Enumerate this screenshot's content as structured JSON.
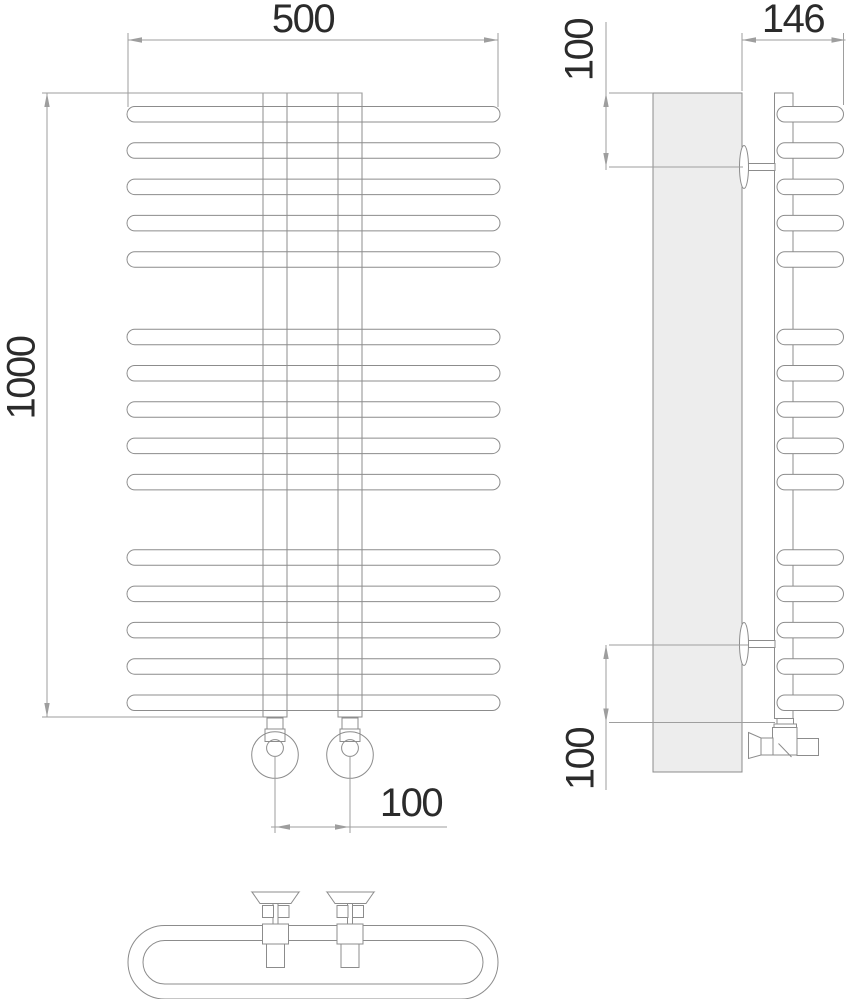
{
  "labels": {
    "front_width": "500",
    "front_height": "1000",
    "tap_spacing": "100",
    "side_depth": "146",
    "side_top_offset": "100",
    "side_bottom_offset": "100"
  },
  "colors": {
    "line": "#8c8c8c",
    "dimension": "#9e9e9e",
    "text": "#2b2b2b",
    "wall_fill": "#ededed"
  }
}
